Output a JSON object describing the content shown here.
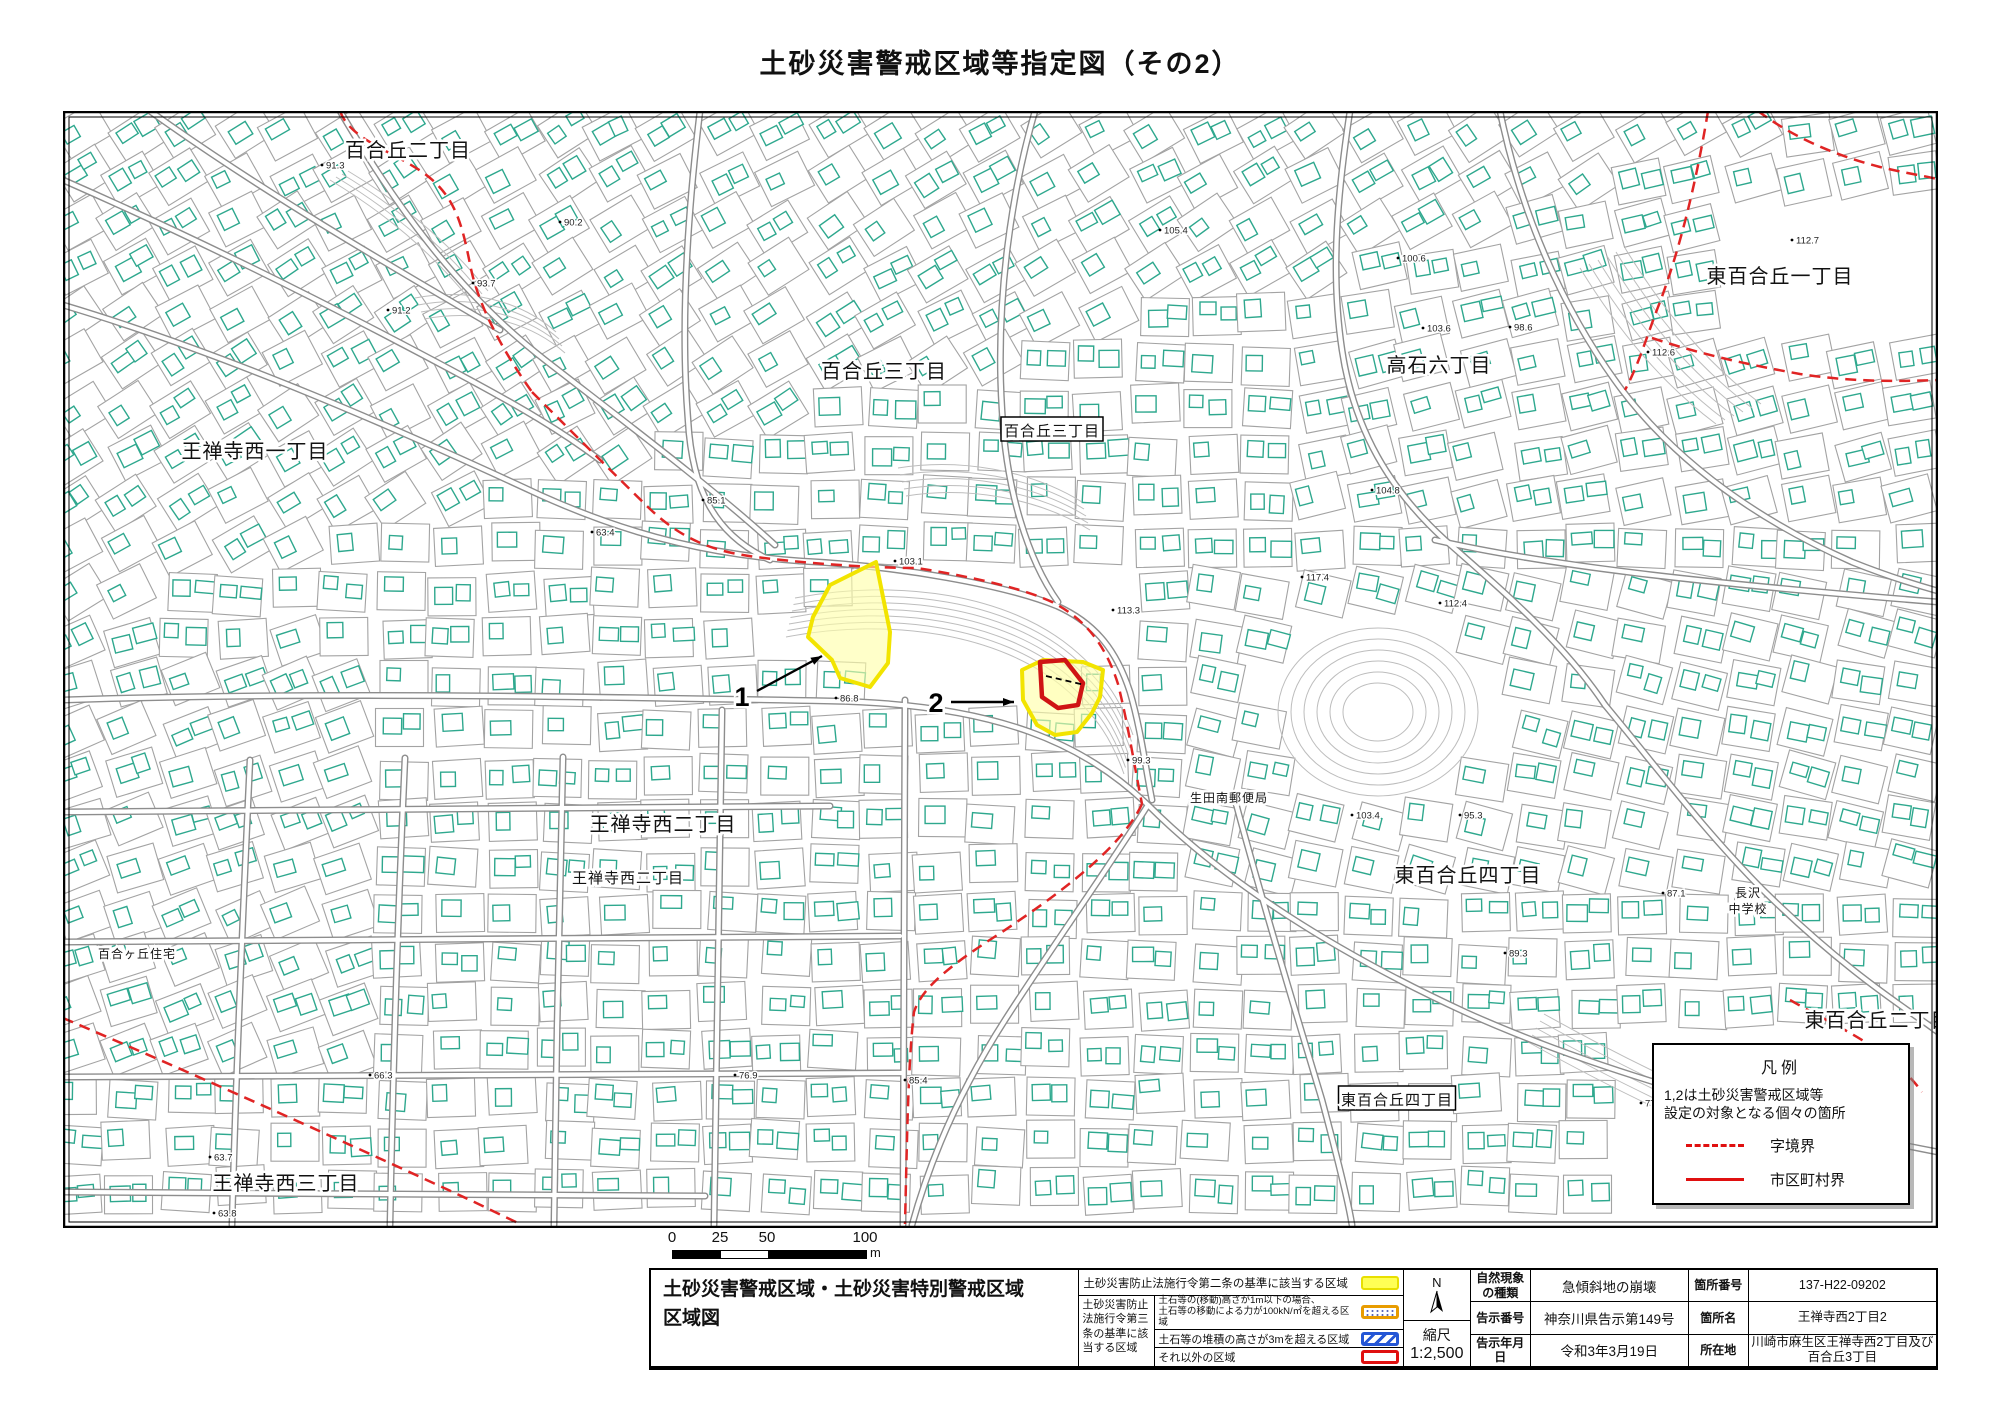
{
  "title": "土砂災害警戒区域等指定図（その2）",
  "map": {
    "labels": [
      {
        "text": "百合丘二丁目",
        "x": 408,
        "y": 157,
        "size": 20
      },
      {
        "text": "百合丘三丁目",
        "x": 884,
        "y": 378,
        "size": 20
      },
      {
        "text": "百合丘三丁目",
        "x": 1052,
        "y": 436,
        "size": 15,
        "boxed": true
      },
      {
        "text": "王禅寺西一丁目",
        "x": 255,
        "y": 458,
        "size": 20
      },
      {
        "text": "高石六丁目",
        "x": 1439,
        "y": 372,
        "size": 20
      },
      {
        "text": "東百合丘一丁目",
        "x": 1780,
        "y": 283,
        "size": 20
      },
      {
        "text": "王禅寺西二丁目",
        "x": 663,
        "y": 831,
        "size": 20
      },
      {
        "text": "王禅寺西二丁目",
        "x": 628,
        "y": 883,
        "size": 15
      },
      {
        "text": "百合ヶ丘住宅",
        "x": 137,
        "y": 958,
        "size": 12
      },
      {
        "text": "王禅寺西三丁目",
        "x": 286,
        "y": 1190,
        "size": 20
      },
      {
        "text": "東百合丘四丁目",
        "x": 1468,
        "y": 882,
        "size": 20
      },
      {
        "text": "東百合丘四丁目",
        "x": 1397,
        "y": 1105,
        "size": 15,
        "boxed": true
      },
      {
        "text": "東百合丘二丁目",
        "x": 1878,
        "y": 1027,
        "size": 20
      },
      {
        "text": "生田南郵便局",
        "x": 1229,
        "y": 802,
        "size": 12
      },
      {
        "text": "長沢中学校",
        "x": 1748,
        "y": 897,
        "size": 12,
        "lines": [
          "長沢",
          "中学校"
        ]
      }
    ],
    "elevations": [
      {
        "v": "91.3",
        "x": 322,
        "y": 165
      },
      {
        "v": "90.2",
        "x": 560,
        "y": 222
      },
      {
        "v": "93.7",
        "x": 473,
        "y": 283
      },
      {
        "v": "91.2",
        "x": 388,
        "y": 310
      },
      {
        "v": "105.4",
        "x": 1160,
        "y": 230
      },
      {
        "v": "112.7",
        "x": 1792,
        "y": 240
      },
      {
        "v": "100.6",
        "x": 1398,
        "y": 258
      },
      {
        "v": "103.6",
        "x": 1423,
        "y": 328
      },
      {
        "v": "98.6",
        "x": 1510,
        "y": 327
      },
      {
        "v": "112.6",
        "x": 1648,
        "y": 352
      },
      {
        "v": "104.8",
        "x": 1372,
        "y": 490
      },
      {
        "v": "85.1",
        "x": 703,
        "y": 500
      },
      {
        "v": "63.4",
        "x": 592,
        "y": 532
      },
      {
        "v": "103.1",
        "x": 895,
        "y": 561
      },
      {
        "v": "117.4",
        "x": 1302,
        "y": 577
      },
      {
        "v": "112.4",
        "x": 1440,
        "y": 603
      },
      {
        "v": "113.3",
        "x": 1113,
        "y": 610
      },
      {
        "v": "86.8",
        "x": 836,
        "y": 698
      },
      {
        "v": "99.3",
        "x": 1128,
        "y": 760
      },
      {
        "v": "103.4",
        "x": 1352,
        "y": 815
      },
      {
        "v": "95.3",
        "x": 1460,
        "y": 815
      },
      {
        "v": "87.1",
        "x": 1663,
        "y": 893
      },
      {
        "v": "89.3",
        "x": 1505,
        "y": 953
      },
      {
        "v": "66.3",
        "x": 370,
        "y": 1075
      },
      {
        "v": "76.9",
        "x": 735,
        "y": 1075
      },
      {
        "v": "85.4",
        "x": 905,
        "y": 1080
      },
      {
        "v": "77.4",
        "x": 1641,
        "y": 1103
      },
      {
        "v": "63.7",
        "x": 210,
        "y": 1157
      },
      {
        "v": "63.8",
        "x": 214,
        "y": 1213
      }
    ],
    "zones": [
      {
        "id": "zone-1",
        "type": "warning-yellow",
        "points": "876,562 885,607 890,632 888,663 870,687 840,678 832,660 808,637 813,617 830,585"
      },
      {
        "id": "zone-2",
        "type": "warning-yellow",
        "points": "1022,670 1043,660 1083,662 1103,670 1100,697 1092,713 1077,732 1055,735 1037,725 1023,700"
      },
      {
        "id": "zone-2-special",
        "type": "special-red",
        "points": "1040,662 1065,660 1083,683 1078,705 1058,708 1042,697"
      }
    ],
    "zone_lot_dash": "M 1046,676 L 1085,685",
    "zone_markers": [
      {
        "label": "1",
        "tx": 742,
        "ty": 706,
        "ax1": 757,
        "ay1": 691,
        "ax2": 822,
        "ay2": 656
      },
      {
        "label": "2",
        "tx": 936,
        "ty": 712,
        "ax1": 951,
        "ay1": 702,
        "ax2": 1014,
        "ay2": 702
      }
    ],
    "boundaries": [
      "M 340,111 C 350,140 395,152 425,174 C 455,196 462,224 470,264 C 478,307 505,354 532,392",
      "M 532,392 C 562,422 612,472 650,509 C 692,549 732,554 764,558 C 822,565 882,568 917,568 C 967,576 1024,588 1054,603 C 1084,619 1105,643 1118,684 C 1128,724 1134,764 1142,804",
      "M 1142,804 C 1122,847 1062,892 1002,932 C 952,964 922,987 914,1012 C 908,1062 907,1142 905,1224",
      "M 1708,111 C 1700,160 1685,235 1660,302 C 1648,332 1640,362 1625,390",
      "M 1652,338 C 1700,354 1745,364 1800,374 C 1845,381 1890,382 1937,380",
      "M 1758,111 C 1790,135 1830,154 1880,167 C 1905,173 1925,176 1937,179",
      "M 63,1018 C 180,1068 330,1135 470,1200 L 520,1224",
      "M 1790,1000 C 1825,1020 1852,1032 1880,1052 C 1898,1065 1912,1078 1922,1092"
    ],
    "legend_box": {
      "title": "凡例",
      "note_lines": [
        "1,2は土砂災害警戒区域等",
        "設定の対象となる個々の箇所"
      ],
      "items": [
        {
          "sample": "red-dashed",
          "label": "字境界"
        },
        {
          "sample": "red-solid",
          "label": "市区町村界"
        }
      ]
    },
    "colors": {
      "building": "#2ea88e",
      "parcel": "#a3a3a3",
      "road_casing": "#8d8d8d",
      "contour": "#bdbdbd",
      "boundary_red": "#e02424",
      "zone_yellow_stroke": "#f2e400",
      "zone_yellow_fill": "#ffffa8",
      "zone_red_stroke": "#cf1414",
      "label_text": "#111111"
    },
    "decor": {
      "seed": 20210319,
      "roads": [
        "M 63,305 C 230,355 400,430 540,495 C 640,540 720,555 800,561",
        "M 340,111 C 392,200 455,290 545,360 C 630,426 715,490 775,545",
        "M 800,561 C 900,566 1005,585 1057,606 C 1097,624 1117,652 1130,692 C 1141,730 1145,765 1152,800",
        "M 63,180 C 200,240 340,310 470,380 C 520,407 560,430 600,460",
        "M 150,111 C 260,190 380,260 500,330",
        "M 700,111 C 688,210 680,320 688,420 C 692,490 715,535 770,560",
        "M 1035,111 C 1012,190 995,300 1002,410 C 1006,490 1028,560 1058,602",
        "M 1350,111 C 1338,190 1330,270 1342,350 C 1354,430 1390,490 1445,540 C 1510,597 1565,645 1605,705",
        "M 63,700 C 300,692 560,696 830,701 C 1000,704 1085,745 1148,805 C 1225,882 1335,952 1465,1012 C 1600,1073 1780,1122 1938,1152",
        "M 250,760 C 243,910 236,1070 232,1225",
        "M 405,758 C 398,910 393,1070 390,1225",
        "M 563,757 C 559,910 556,1070 554,1225",
        "M 722,710 C 719,880 716,1050 714,1225",
        "M 63,812 L 830,806",
        "M 63,942 L 900,936",
        "M 63,1077 L 902,1073",
        "M 63,1192 L 705,1196",
        "M 905,700 L 903,1225",
        "M 1235,800 C 1262,900 1292,1000 1322,1100 C 1338,1160 1348,1200 1352,1225",
        "M 1500,111 C 1520,210 1562,310 1622,390 C 1680,466 1762,522 1852,562 C 1892,578 1920,586 1938,591",
        "M 1605,705 C 1655,765 1705,832 1765,892 C 1852,977 1912,1012 1938,1032",
        "M 1435,540 C 1545,565 1690,582 1938,602",
        "M 1148,805 C 1100,880 1050,950 1005,1020 C 960,1090 930,1160 912,1225"
      ],
      "contours": [
        {
          "d": "M 795,598 C 900,578 1008,595 1072,648 C 1108,678 1122,704 1133,735",
          "n": 7,
          "dx": -1.5,
          "dy": 6.5
        },
        {
          "d": "M 1580,268 C 1618,330 1660,382 1716,424",
          "n": 6,
          "dx": 9,
          "dy": -4
        },
        {
          "d": "M 415,298 C 468,288 520,300 556,332",
          "n": 4,
          "dx": 3,
          "dy": 7
        },
        {
          "d": "M 1528,1042 C 1600,1082 1680,1122 1758,1152",
          "n": 5,
          "dx": 4,
          "dy": -7
        },
        {
          "d": "M 898,468 C 960,458 1030,470 1082,502",
          "n": 5,
          "dx": 2,
          "dy": 7
        },
        {
          "d": "M 330,180 C 380,210 430,250 470,300",
          "n": 4,
          "dx": 6,
          "dy": -3
        }
      ],
      "park_rings": {
        "cx": 1378,
        "cy": 712,
        "rx": 100,
        "ry": 84,
        "n": 6,
        "step": 13
      }
    }
  },
  "scale_bar": {
    "ticks": [
      "0",
      "25",
      "50",
      "100"
    ],
    "unit": "m"
  },
  "title_block": {
    "sheet_title": [
      "土砂災害警戒区域・土砂災害特別警戒区域",
      "区域図"
    ],
    "article2_row": {
      "label": "土砂災害防止法施行令第二条の基準に該当する区域",
      "swatch": "yellow"
    },
    "article3_label": "土砂災害防止法施行令第三条の基準に該当する区域",
    "article3_rows": [
      {
        "lines": [
          "土石等の(移動)高さが1m以下の場合、",
          "土石等の移動による力が100kN/㎡を超える区域"
        ],
        "swatch": "orange-dots"
      },
      {
        "lines": [
          "土石等の堆積の高さが3mを超える区域"
        ],
        "swatch": "blue-hatch"
      },
      {
        "lines": [
          "それ以外の区域"
        ],
        "swatch": "red-outline"
      }
    ],
    "north_label": "N",
    "scale_label": "縮尺",
    "scale_value": "1:2,500",
    "info_rows": [
      [
        "自然現象の種類",
        "急傾斜地の崩壊",
        "箇所番号",
        "137-H22-09202"
      ],
      [
        "告示番号",
        "神奈川県告示第149号",
        "箇所名",
        "王禅寺西2丁目2"
      ],
      [
        "告示年月日",
        "令和3年3月19日",
        "所在地",
        "川崎市麻生区王禅寺西2丁目及び百合丘3丁目"
      ]
    ]
  }
}
